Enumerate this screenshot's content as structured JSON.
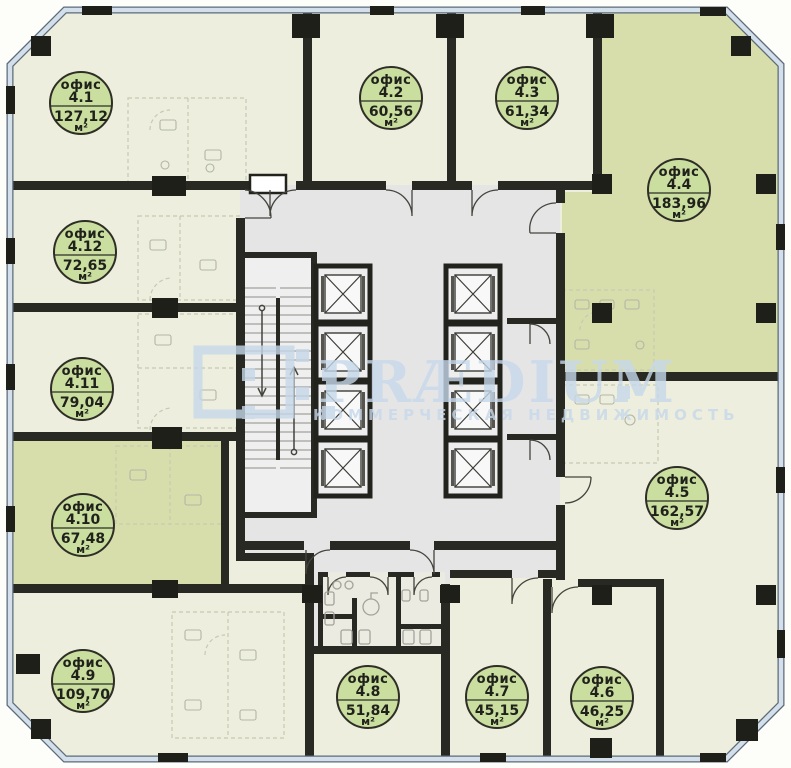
{
  "app": {
    "type": "office-floor-plan",
    "language": "ru"
  },
  "watermark": {
    "brand": "PRÆDIUM",
    "subtitle": "КОММЕРЧЕСКАЯ НЕДВИЖИМОСТЬ"
  },
  "labels": {
    "unit_word": "офис",
    "area_unit": "м²"
  },
  "units": [
    {
      "id": "4.1",
      "area": "127,12",
      "highlighted": false
    },
    {
      "id": "4.2",
      "area": "60,56",
      "highlighted": false
    },
    {
      "id": "4.3",
      "area": "61,34",
      "highlighted": false
    },
    {
      "id": "4.4",
      "area": "183,96",
      "highlighted": true
    },
    {
      "id": "4.5",
      "area": "162,57",
      "highlighted": false
    },
    {
      "id": "4.6",
      "area": "46,25",
      "highlighted": false
    },
    {
      "id": "4.7",
      "area": "45,15",
      "highlighted": false
    },
    {
      "id": "4.8",
      "area": "51,84",
      "highlighted": false
    },
    {
      "id": "4.9",
      "area": "109,70",
      "highlighted": false
    },
    {
      "id": "4.10",
      "area": "67,48",
      "highlighted": true
    },
    {
      "id": "4.11",
      "area": "79,04",
      "highlighted": false
    },
    {
      "id": "4.12",
      "area": "72,65",
      "highlighted": false
    }
  ],
  "colors": {
    "room_fill": "#edeedd",
    "highlight_fill": "#d8deab",
    "badge_fill": "#c9de9f",
    "core_fill": "#e5e5e6",
    "wall": "#292923",
    "facade": "#d3e0ec",
    "watermark": "#c6d8ea"
  }
}
